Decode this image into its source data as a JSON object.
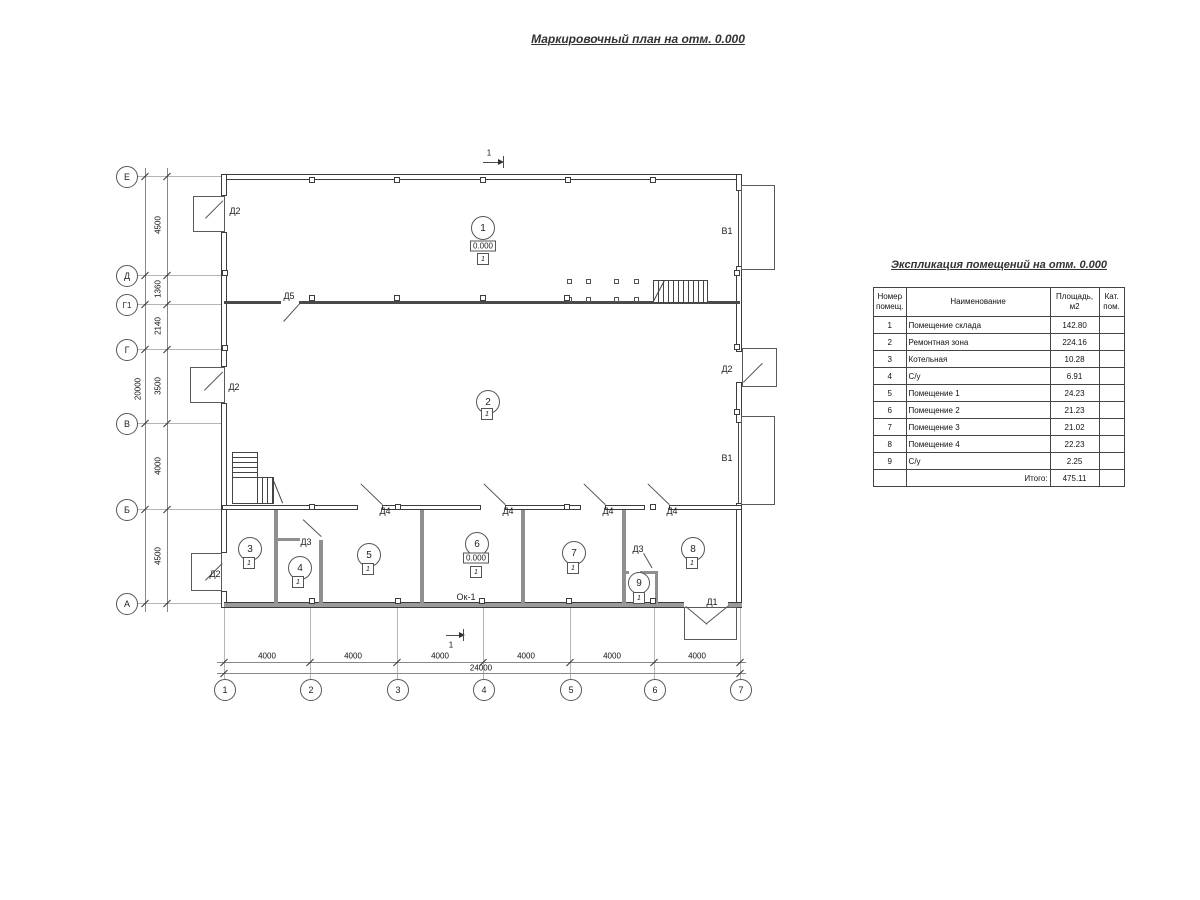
{
  "page": {
    "title": "Маркировочный план на отм. 0.000"
  },
  "plan": {
    "section_mark": "1",
    "left_axes": [
      "Е",
      "Д",
      "Г1",
      "Г",
      "В",
      "Б",
      "А"
    ],
    "left_dims": [
      "4500",
      "1360",
      "2140",
      "3500",
      "4000",
      "4500"
    ],
    "left_total": "20000",
    "bottom_axes": [
      "1",
      "2",
      "3",
      "4",
      "5",
      "6",
      "7"
    ],
    "bottom_dims": [
      "4000",
      "4000",
      "4000",
      "4000",
      "4000",
      "4000"
    ],
    "bottom_total": "24000",
    "door_labels": {
      "d1": "Д1",
      "d2": "Д2",
      "d3": "Д3",
      "d4": "Д4",
      "d5": "Д5"
    },
    "gate_label": "В1",
    "window_label": "Ок-1",
    "rooms": [
      {
        "num": "1",
        "level": "0.000",
        "tag": "1"
      },
      {
        "num": "2",
        "tag": "1"
      },
      {
        "num": "3",
        "tag": "1"
      },
      {
        "num": "4",
        "tag": "1"
      },
      {
        "num": "5",
        "tag": "1"
      },
      {
        "num": "6",
        "level": "0.000",
        "tag": "1"
      },
      {
        "num": "7",
        "tag": "1"
      },
      {
        "num": "8",
        "tag": "1"
      },
      {
        "num": "9",
        "tag": "1"
      }
    ]
  },
  "schedule": {
    "title": "Экспликация помещений на отм. 0.000",
    "headers": {
      "num": "Номер\nпомещ.",
      "name": "Наименование",
      "area": "Площадь,\nм2",
      "cat": "Кат.\nпом."
    },
    "rows": [
      {
        "num": "1",
        "name": "Помещение склада",
        "area": "142.80",
        "cat": ""
      },
      {
        "num": "2",
        "name": "Ремонтная зона",
        "area": "224.16",
        "cat": ""
      },
      {
        "num": "3",
        "name": "Котельная",
        "area": "10.28",
        "cat": ""
      },
      {
        "num": "4",
        "name": "С/у",
        "area": "6.91",
        "cat": ""
      },
      {
        "num": "5",
        "name": "Помещение 1",
        "area": "24.23",
        "cat": ""
      },
      {
        "num": "6",
        "name": "Помещение 2",
        "area": "21.23",
        "cat": ""
      },
      {
        "num": "7",
        "name": "Помещение 3",
        "area": "21.02",
        "cat": ""
      },
      {
        "num": "8",
        "name": "Помещение 4",
        "area": "22.23",
        "cat": ""
      },
      {
        "num": "9",
        "name": "С/у",
        "area": "2.25",
        "cat": ""
      }
    ],
    "total_label": "Итого:",
    "total_value": "475.11"
  }
}
